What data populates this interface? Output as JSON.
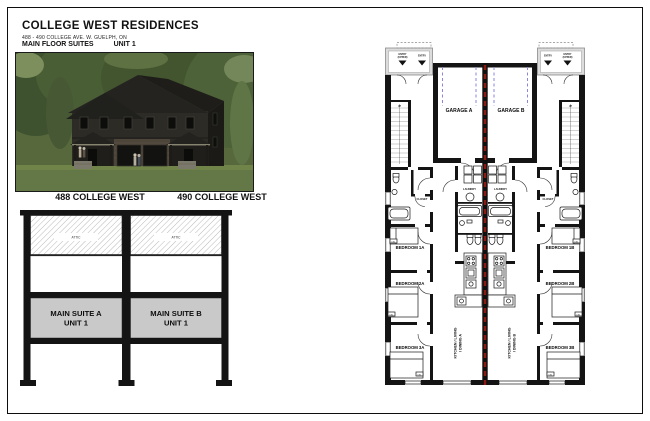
{
  "header": {
    "title": "COLLEGE WEST RESIDENCES",
    "address": "488 - 490 COLLEGE AVE. W. GUELPH, ON",
    "floor_label": "MAIN FLOOR SUITES",
    "unit_label": "UNIT 1"
  },
  "photo": {
    "label_left": "488 COLLEGE WEST",
    "label_right": "490 COLLEGE WEST"
  },
  "section": {
    "attic": "ATTIC",
    "suite_a_line1": "MAIN SUITE A",
    "suite_a_line2": "UNIT 1",
    "suite_b_line1": "MAIN SUITE B",
    "suite_b_line2": "UNIT 1"
  },
  "floorplan": {
    "entry": "ENTRY",
    "entry_upper_line1": "ENTRY",
    "entry_upper_line2": "(UPPER)",
    "up": "UP",
    "garage_a": "GARAGE A",
    "garage_b": "GARAGE B",
    "laundry": "LAUNDRY",
    "closet": "CLOSET",
    "bedroom_1a": "BEDROOM 1A",
    "bedroom_2a": "BEDROOM 2A",
    "bedroom_3a": "BEDROOM 3A",
    "bedroom_1b": "BEDROOM 1B",
    "bedroom_2b": "BEDROOM 2B",
    "bedroom_3b": "BEDROOM 3B",
    "kitchen_line1": "KITCHEN / LIVING",
    "kitchen_a_line2": "/ DINING A",
    "kitchen_b_line2": "/ DINING B",
    "bed_tag": "DBL"
  },
  "colors": {
    "party_wall_red": "#8b1a10",
    "garage_dash_blue": "#8a86e0",
    "suite_gray": "#c9c9c9",
    "wall_black": "#141414"
  }
}
